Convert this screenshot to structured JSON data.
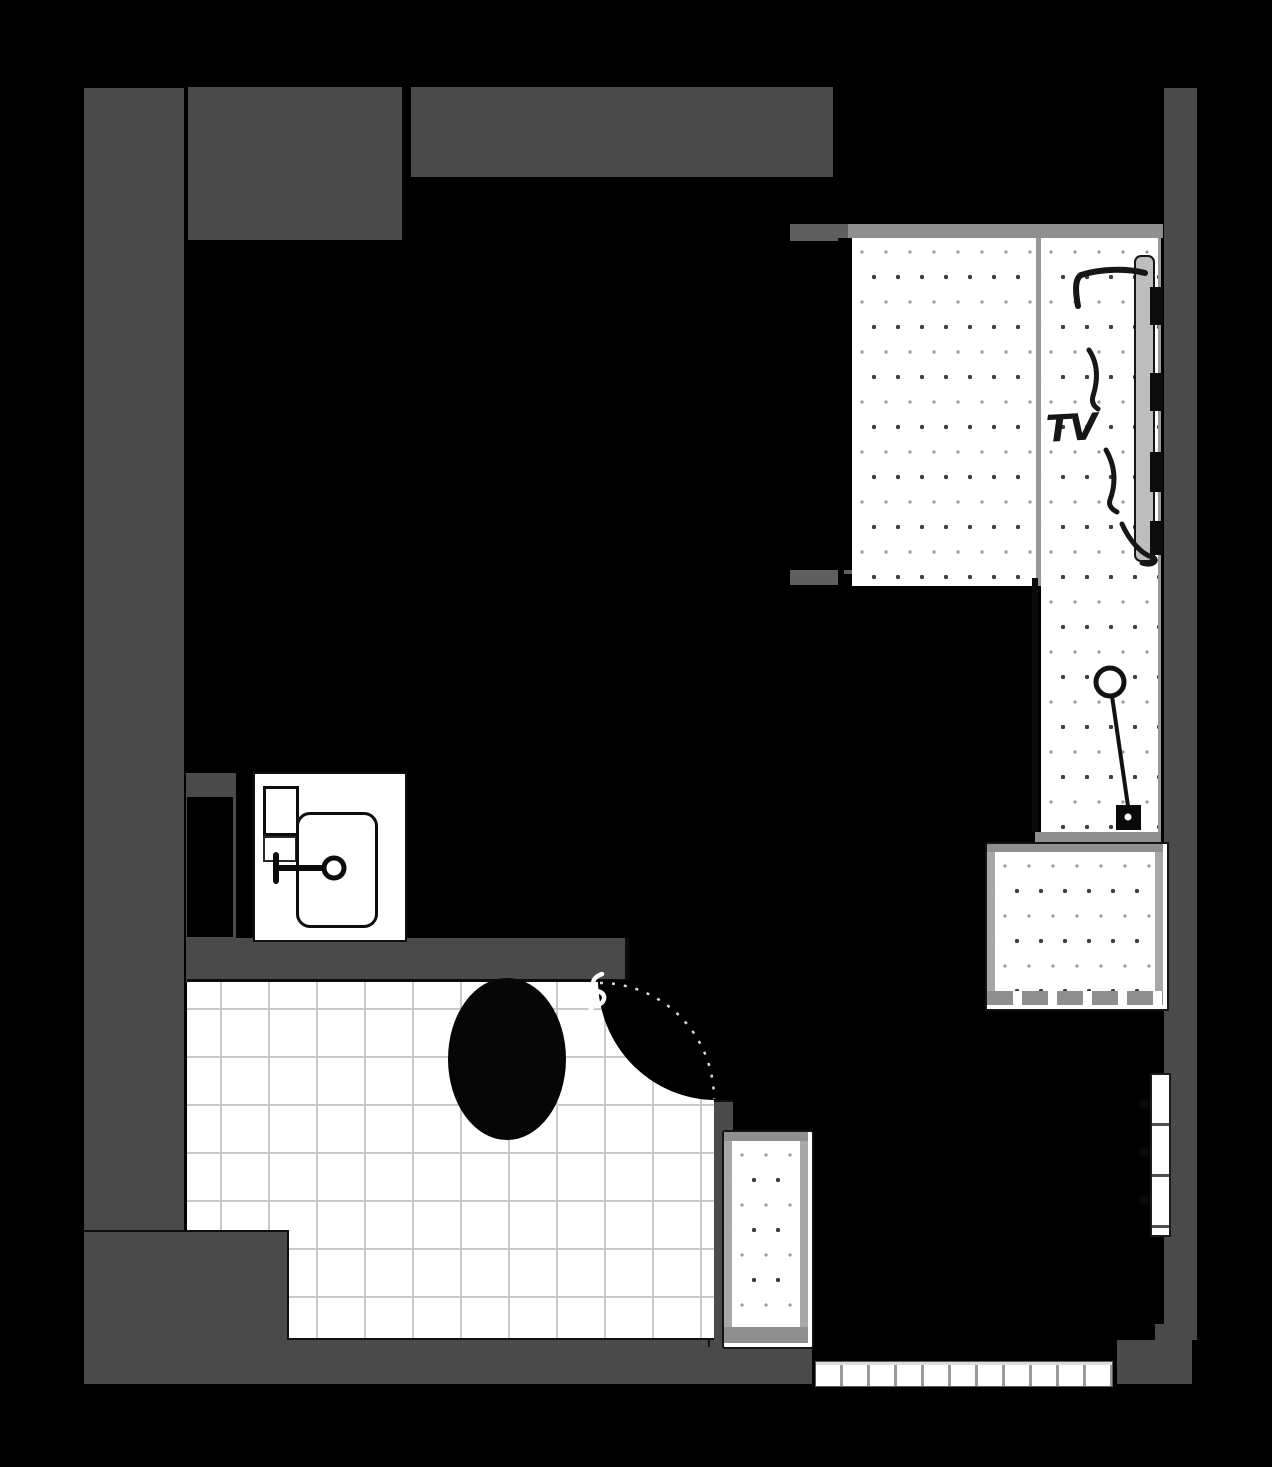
{
  "plan": {
    "type": "apartment-floor-plan",
    "labels": {
      "tv": "TV"
    },
    "palette": {
      "background": "#000000",
      "wall": "#4a4a4a",
      "bar_dark": "#5f5f5f",
      "bar_mid": "#8f8f8f",
      "tile_line": "#c9c9c9",
      "ink": "#121212",
      "floor_white": "#ffffff"
    },
    "layout": {
      "wall-left": [
        84,
        88,
        100,
        1142
      ],
      "wall-foot-bottom-left": [
        84,
        1230,
        203,
        108
      ],
      "wall-bottom": [
        84,
        1338,
        728,
        46
      ],
      "wall-top-left-block": [
        188,
        87,
        214,
        153
      ],
      "wall-top": [
        411,
        87,
        422,
        90
      ],
      "wall-right": [
        1164,
        88,
        33,
        1252
      ],
      "wall-bottom-right": [
        1117,
        1340,
        75,
        44
      ],
      "wall-bottom-right-step": [
        1155,
        1324,
        37,
        16
      ],
      "wall-sink-stub": [
        186,
        773,
        50,
        209
      ],
      "closet-niche": [
        187,
        797,
        46,
        140
      ],
      "wall-bath-top": [
        187,
        938,
        438,
        41
      ],
      "wall-door-stub": [
        708,
        1100,
        23,
        245
      ],
      "wall-bed-head-bar": [
        790,
        224,
        60,
        17
      ],
      "wall-bed-foot-bar-a": [
        790,
        570,
        48,
        15
      ],
      "wall-bed-foot-bar-b": [
        844,
        570,
        20,
        15
      ],
      "bed-top-bar": [
        848,
        224,
        315,
        14
      ],
      "bed-left-dashes": [
        838,
        238,
        14,
        348
      ],
      "bed-rug": [
        852,
        238,
        184,
        348
      ],
      "bed-strip-divider": [
        1036,
        238,
        5,
        348
      ],
      "floor-strip": [
        1041,
        238,
        117,
        604
      ],
      "strip-left-border": [
        1032,
        578,
        6,
        254
      ],
      "strip-bottom-bar": [
        1035,
        832,
        126,
        10
      ],
      "bench-box": [
        985,
        842,
        180,
        165
      ],
      "bench-top-bar": [
        0,
        0,
        176,
        8
      ],
      "bench-left-strip": [
        0,
        8,
        8,
        147
      ],
      "bench-right-strip": [
        168,
        8,
        8,
        147
      ],
      "bench-core": [
        8,
        8,
        160,
        139
      ],
      "bench-bottom-dashes": [
        0,
        147,
        176,
        14
      ],
      "tv-screen-slab": [
        1134,
        255,
        17,
        303
      ],
      "tv-dash-1": [
        1150,
        287,
        13,
        38
      ],
      "tv-dash-2": [
        1150,
        373,
        13,
        38
      ],
      "tv-dash-3": [
        1150,
        452,
        13,
        40
      ],
      "tv-dash-4": [
        1150,
        521,
        13,
        34
      ],
      "tv-label-box": [
        1046,
        406,
        70,
        48
      ],
      "window-bottom": [
        815,
        1361,
        296,
        24
      ],
      "window-right": [
        1150,
        1073,
        17,
        160
      ],
      "right-window-dot-1": [
        1140,
        1100,
        8,
        8
      ],
      "right-window-dot-2": [
        1140,
        1148,
        8,
        8
      ],
      "right-window-dot-3": [
        1140,
        1196,
        8,
        8
      ],
      "bath-tiles": [
        187,
        982,
        527,
        356
      ],
      "door-swing-region": [
        598,
        980,
        118,
        120
      ],
      "toilet-bowl": [
        448,
        978,
        118,
        162
      ],
      "vanity-box": [
        253,
        772,
        150,
        166
      ],
      "vanity-shelf-1": [
        263,
        786,
        30,
        44
      ],
      "vanity-shelf-2": [
        263,
        836,
        30,
        22
      ],
      "sink-basin": [
        296,
        812,
        76,
        110
      ],
      "radiator-box": [
        722,
        1130,
        88,
        215
      ],
      "rad-top-bar": [
        0,
        0,
        84,
        9
      ],
      "rad-left-strip": [
        0,
        9,
        8,
        186
      ],
      "rad-right-strip": [
        76,
        9,
        8,
        186
      ],
      "rad-core": [
        8,
        9,
        68,
        186
      ],
      "rad-bottom-bar": [
        0,
        195,
        84,
        16
      ]
    }
  }
}
